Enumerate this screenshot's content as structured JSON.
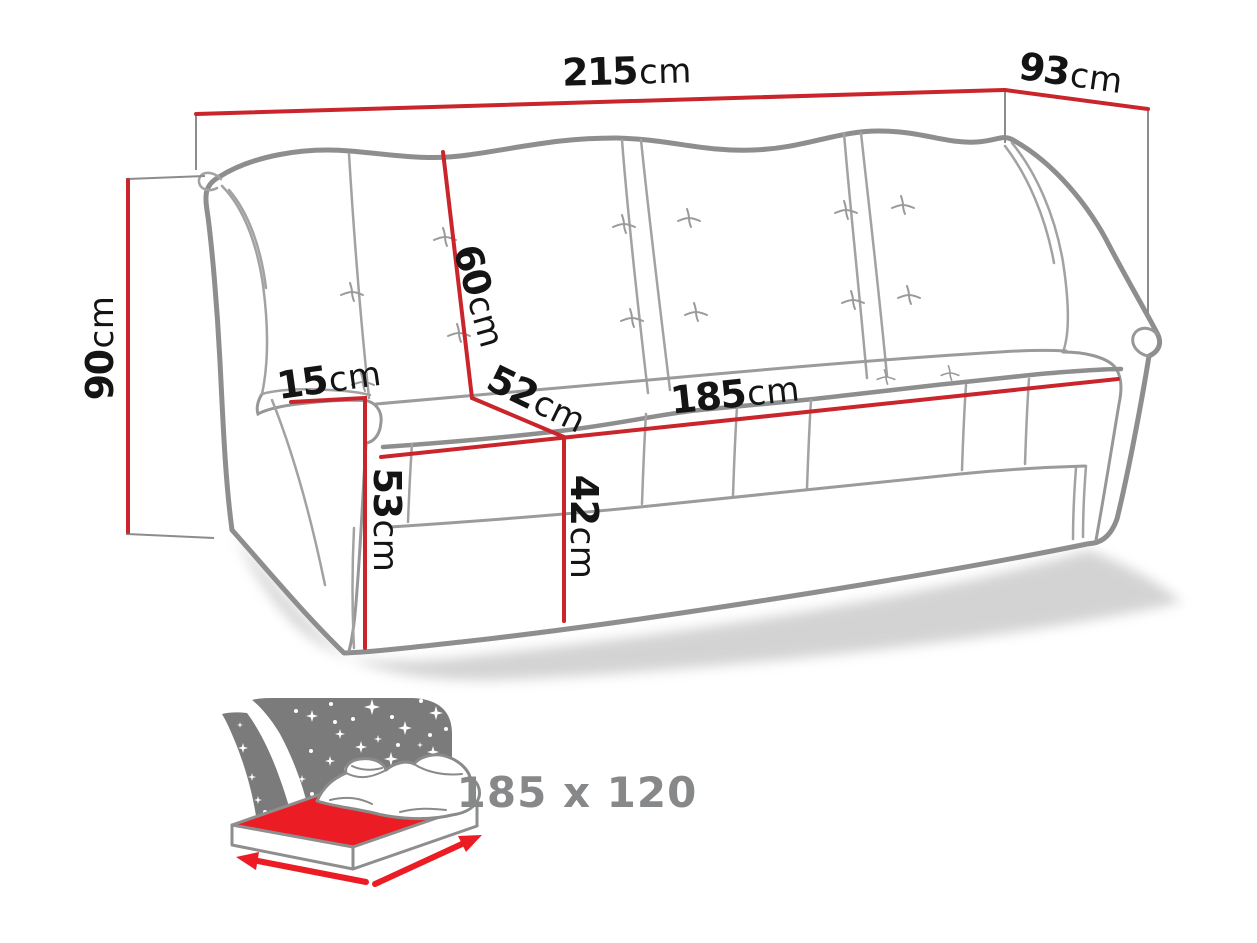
{
  "diagram": {
    "title": "sofa-dimensions-diagram",
    "dimensions": {
      "total_width": {
        "value": "215",
        "unit": "cm"
      },
      "total_depth": {
        "value": "93",
        "unit": "cm"
      },
      "total_height": {
        "value": "90",
        "unit": "cm"
      },
      "backrest_height": {
        "value": "60",
        "unit": "cm"
      },
      "seat_depth": {
        "value": "52",
        "unit": "cm"
      },
      "armrest_width": {
        "value": "15",
        "unit": "cm"
      },
      "seat_width": {
        "value": "185",
        "unit": "cm"
      },
      "armrest_height": {
        "value": "53",
        "unit": "cm"
      },
      "seat_height": {
        "value": "42",
        "unit": "cm"
      }
    },
    "sleeping_area": {
      "size": "185 x 120",
      "icon": "sleeping-function-bed-icon"
    },
    "colors": {
      "dimension_line_red": "#c9252b",
      "highlight_red": "#ec1c24",
      "sofa_outline_grey": "#8e8e8e",
      "seam_grey": "#a2a2a2",
      "night_panel_grey": "#7b7b7b",
      "size_label_grey": "#87888a",
      "label_text_black": "#141414"
    }
  }
}
